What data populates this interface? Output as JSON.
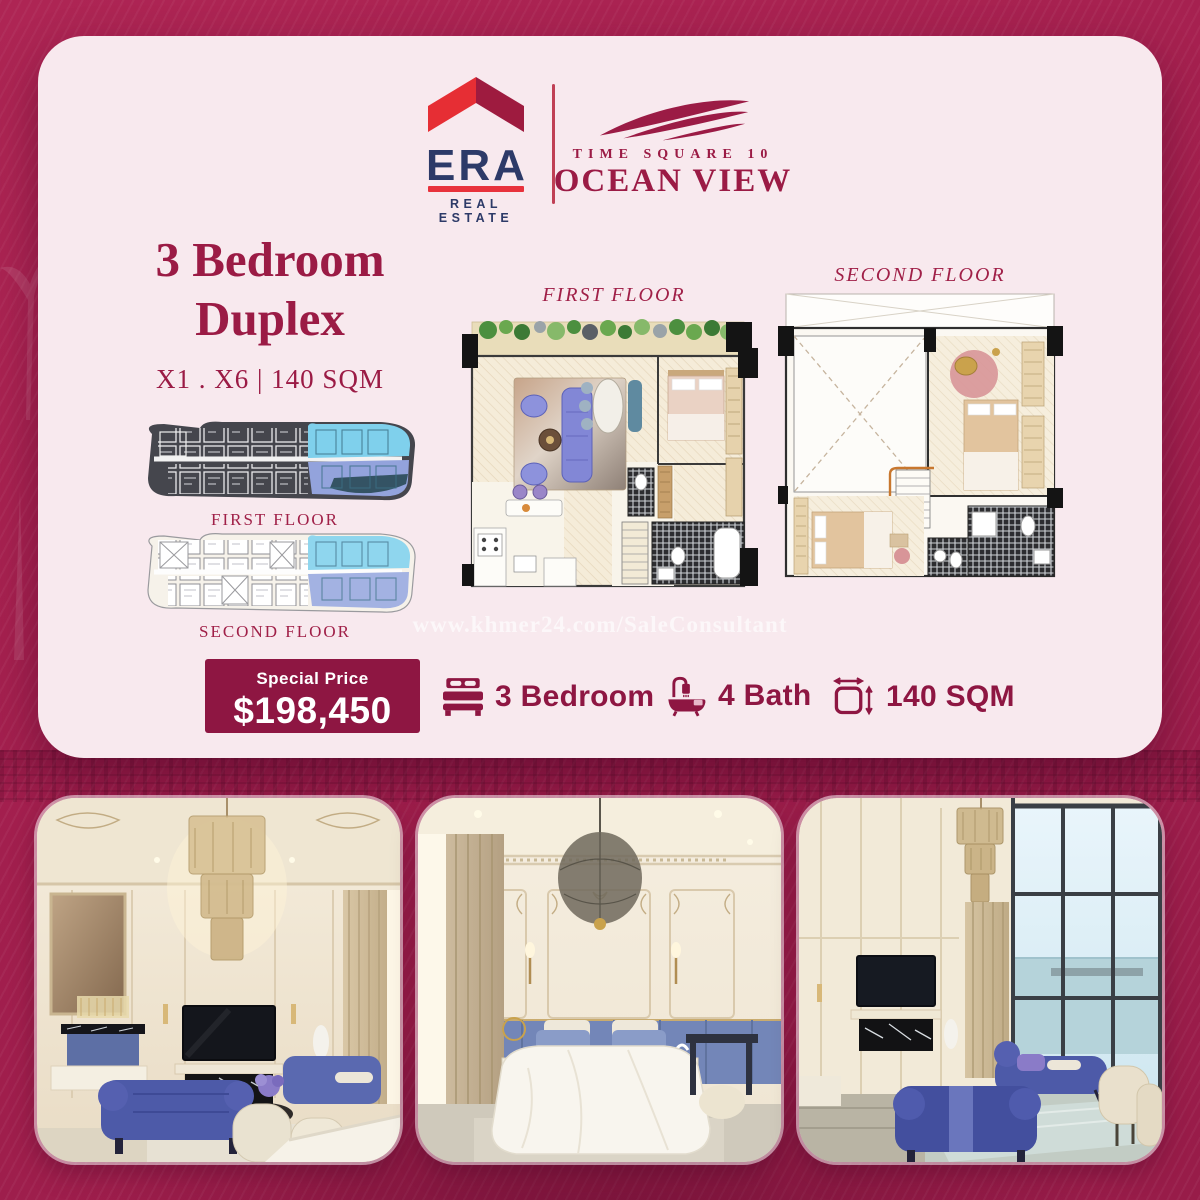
{
  "colors": {
    "background": "#a31f4e",
    "card": "#f8e9ee",
    "accent": "#9b1b45",
    "badge": "#8e1642",
    "navy": "#2d3a68",
    "era_red": "#e62e34",
    "era_dark_red": "#9e1b3f",
    "highlight_cyan": "#7fd0ec",
    "highlight_blue": "#93a3dc"
  },
  "header": {
    "era": {
      "name": "ERA",
      "tagline": "REAL ESTATE"
    },
    "project": {
      "line1": "TIME SQUARE 10",
      "line2": "OCEAN VIEW"
    }
  },
  "listing": {
    "title_line1": "3 Bedroom",
    "title_line2": "Duplex",
    "spec": "X1 . X6  |  140 SQM",
    "price": {
      "label": "Special Price",
      "value": "$198,450"
    },
    "features": [
      {
        "icon": "bed-icon",
        "label": "3 Bedroom"
      },
      {
        "icon": "bath-icon",
        "label": "4 Bath"
      },
      {
        "icon": "area-icon",
        "label": "140 SQM"
      }
    ]
  },
  "floorplans": {
    "site_plates": [
      {
        "label": "FIRST FLOOR"
      },
      {
        "label": "SECOND FLOOR"
      }
    ],
    "unit_plans": [
      {
        "label": "FIRST FLOOR"
      },
      {
        "label": "SECOND FLOOR"
      }
    ]
  },
  "watermark": "www.khmer24.com/SaleConsultant"
}
